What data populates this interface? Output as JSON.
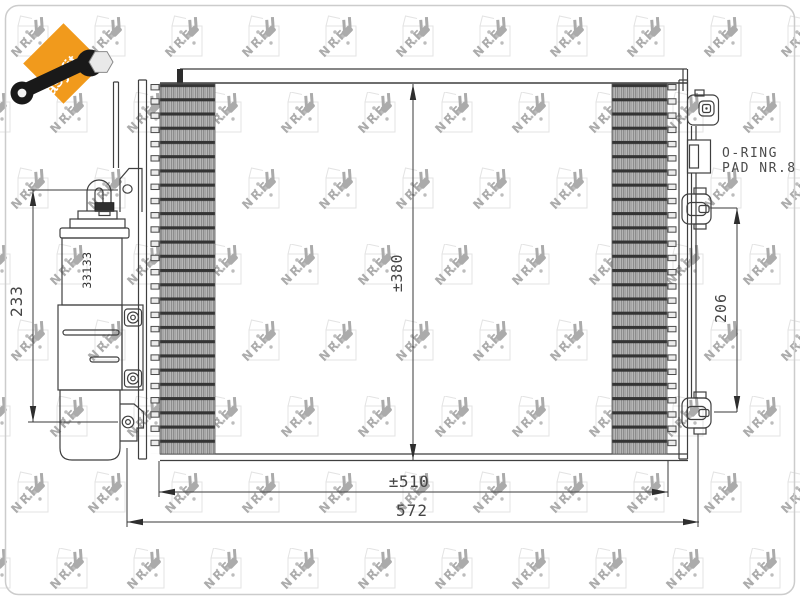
{
  "logo": {
    "label": "easyfit",
    "color": "#f19a1c"
  },
  "watermark": {
    "brand": "NRF"
  },
  "drawing": {
    "part_number": "33133",
    "note": {
      "line1": "O-RING",
      "line2": "PAD NR.8"
    },
    "dims": {
      "drier_height": "233",
      "core_height": "±380",
      "port_distance": "206",
      "core_width": "±510",
      "overall_width": "572"
    }
  }
}
